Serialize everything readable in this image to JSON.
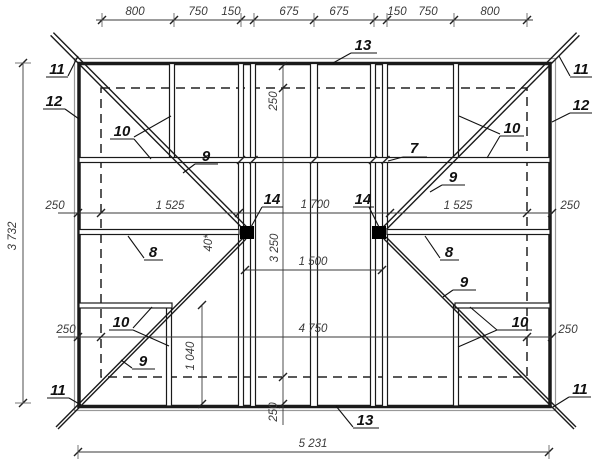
{
  "drawing": {
    "kind": "roof-framing-plan",
    "dims": {
      "top": [
        "800",
        "750",
        "150",
        "675",
        "675",
        "150",
        "750",
        "800"
      ],
      "row_mid": [
        "250",
        "1 525",
        "1 700",
        "1 525",
        "250"
      ],
      "row_low": [
        "250",
        "4 750",
        "250"
      ],
      "col_center": [
        "250",
        "3 250",
        "250"
      ],
      "overall_width": "5 231",
      "overall_height": "3 732",
      "between_posts": "1 500",
      "stud_height": "1 040",
      "hip_gap": "40*"
    },
    "labels": {
      "n7": "7",
      "n8": "8",
      "n9": "9",
      "n10": "10",
      "n11": "11",
      "n12": "12",
      "n13": "13",
      "n14": "14"
    }
  }
}
